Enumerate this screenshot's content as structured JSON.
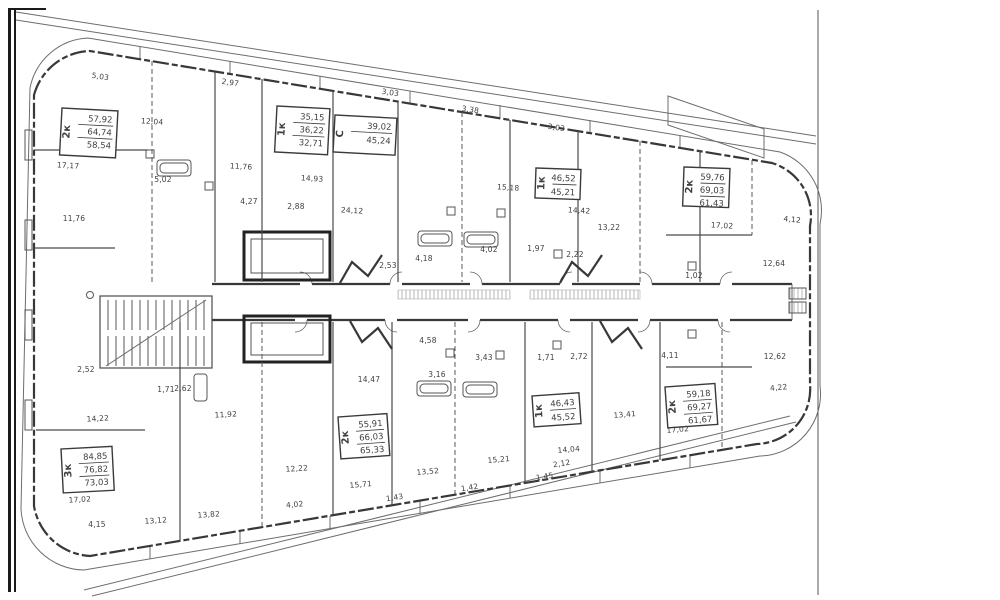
{
  "drawing": {
    "kind": "residential-floor-plan",
    "colors": {
      "paper": "#ffffff",
      "ink": "#3f3f3f",
      "frame": "#1a1a1a",
      "hatch": "#999999"
    }
  },
  "stamps": [
    {
      "type": "2к",
      "areas": [
        "57,92",
        "64,74",
        "58,54"
      ],
      "x": 62,
      "y": 108,
      "w": 56,
      "h": 47,
      "r": 3
    },
    {
      "type": "1к",
      "areas": [
        "35,15",
        "36,22",
        "32,71"
      ],
      "x": 277,
      "y": 106,
      "w": 53,
      "h": 46,
      "r": 3
    },
    {
      "type": "С",
      "areas": [
        "39,02",
        "45,24"
      ],
      "x": 335,
      "y": 115,
      "w": 62,
      "h": 37,
      "r": 3
    },
    {
      "type": "1к",
      "areas": [
        "46,52",
        "45,21"
      ],
      "x": 536,
      "y": 168,
      "w": 45,
      "h": 30,
      "r": 2
    },
    {
      "type": "2к",
      "areas": [
        "59,76",
        "69,03",
        "61,43"
      ],
      "x": 684,
      "y": 167,
      "w": 46,
      "h": 39,
      "r": 2
    },
    {
      "type": "3к",
      "areas": [
        "84,85",
        "76,82",
        "73,03"
      ],
      "x": 61,
      "y": 449,
      "w": 51,
      "h": 44,
      "r": -3
    },
    {
      "type": "2к",
      "areas": [
        "55,91",
        "66,03",
        "65,33"
      ],
      "x": 338,
      "y": 417,
      "w": 49,
      "h": 42,
      "r": -4
    },
    {
      "type": "1к",
      "areas": [
        "46,43",
        "45,52"
      ],
      "x": 532,
      "y": 396,
      "w": 47,
      "h": 31,
      "r": -4
    },
    {
      "type": "2к",
      "areas": [
        "59,18",
        "69,27",
        "61,67"
      ],
      "x": 665,
      "y": 387,
      "w": 50,
      "h": 41,
      "r": -4
    }
  ],
  "room_labels": [
    {
      "t": "5,03",
      "x": 100,
      "y": 79,
      "r": 8
    },
    {
      "t": "2,97",
      "x": 230,
      "y": 85,
      "r": 8
    },
    {
      "t": "3,03",
      "x": 390,
      "y": 95,
      "r": 8
    },
    {
      "t": "3,38",
      "x": 470,
      "y": 112,
      "r": 8
    },
    {
      "t": "3,03",
      "x": 556,
      "y": 130,
      "r": 8
    },
    {
      "t": "12,04",
      "x": 152,
      "y": 124,
      "r": 4
    },
    {
      "t": "17,17",
      "x": 68,
      "y": 168,
      "r": 3
    },
    {
      "t": "5,02",
      "x": 163,
      "y": 182,
      "r": 0
    },
    {
      "t": "11,76",
      "x": 241,
      "y": 169,
      "r": 3
    },
    {
      "t": "14,93",
      "x": 312,
      "y": 181,
      "r": 3
    },
    {
      "t": "15,18",
      "x": 508,
      "y": 190,
      "r": 4
    },
    {
      "t": "4,27",
      "x": 249,
      "y": 204,
      "r": 0
    },
    {
      "t": "2,88",
      "x": 296,
      "y": 209,
      "r": 0
    },
    {
      "t": "11,76",
      "x": 74,
      "y": 221,
      "r": 0
    },
    {
      "t": "24,12",
      "x": 352,
      "y": 213,
      "r": 3
    },
    {
      "t": "14,42",
      "x": 579,
      "y": 213,
      "r": 3
    },
    {
      "t": "13,22",
      "x": 609,
      "y": 230,
      "r": 0
    },
    {
      "t": "17,02",
      "x": 722,
      "y": 228,
      "r": 3
    },
    {
      "t": "4,12",
      "x": 792,
      "y": 222,
      "r": 6
    },
    {
      "t": "4,18",
      "x": 424,
      "y": 261,
      "r": 0
    },
    {
      "t": "4,02",
      "x": 489,
      "y": 252,
      "r": 0
    },
    {
      "t": "1,97",
      "x": 536,
      "y": 251,
      "r": 0
    },
    {
      "t": "2,22",
      "x": 575,
      "y": 257,
      "r": 0
    },
    {
      "t": "2,53",
      "x": 388,
      "y": 268,
      "r": 0
    },
    {
      "t": "12,64",
      "x": 774,
      "y": 266,
      "r": 0
    },
    {
      "t": "1,02",
      "x": 694,
      "y": 278,
      "r": 0
    },
    {
      "t": "2,52",
      "x": 86,
      "y": 372,
      "r": 0
    },
    {
      "t": "1,71",
      "x": 166,
      "y": 392,
      "r": 0
    },
    {
      "t": "2,62",
      "x": 183,
      "y": 391,
      "r": 0
    },
    {
      "t": "12,62",
      "x": 775,
      "y": 359,
      "r": 0
    },
    {
      "t": "4,11",
      "x": 670,
      "y": 358,
      "r": 0
    },
    {
      "t": "4,22",
      "x": 779,
      "y": 390,
      "r": -6
    },
    {
      "t": "14,47",
      "x": 369,
      "y": 382,
      "r": 0
    },
    {
      "t": "4,58",
      "x": 428,
      "y": 343,
      "r": 0
    },
    {
      "t": "3,16",
      "x": 437,
      "y": 377,
      "r": 0
    },
    {
      "t": "3,43",
      "x": 484,
      "y": 360,
      "r": 0
    },
    {
      "t": "1,71",
      "x": 546,
      "y": 360,
      "r": 0
    },
    {
      "t": "2,72",
      "x": 579,
      "y": 359,
      "r": 0
    },
    {
      "t": "14,22",
      "x": 98,
      "y": 421,
      "r": -3
    },
    {
      "t": "11,92",
      "x": 226,
      "y": 417,
      "r": -3
    },
    {
      "t": "17,02",
      "x": 80,
      "y": 502,
      "r": -3
    },
    {
      "t": "4,15",
      "x": 97,
      "y": 527,
      "r": 0
    },
    {
      "t": "13,12",
      "x": 156,
      "y": 523,
      "r": -4
    },
    {
      "t": "13,82",
      "x": 209,
      "y": 517,
      "r": -4
    },
    {
      "t": "12,22",
      "x": 297,
      "y": 471,
      "r": -4
    },
    {
      "t": "4,02",
      "x": 295,
      "y": 507,
      "r": -5
    },
    {
      "t": "15,71",
      "x": 361,
      "y": 487,
      "r": -5
    },
    {
      "t": "13,52",
      "x": 428,
      "y": 474,
      "r": -5
    },
    {
      "t": "15,21",
      "x": 499,
      "y": 462,
      "r": -5
    },
    {
      "t": "14,04",
      "x": 569,
      "y": 452,
      "r": -5
    },
    {
      "t": "13,41",
      "x": 625,
      "y": 417,
      "r": -5
    },
    {
      "t": "17,02",
      "x": 678,
      "y": 432,
      "r": -5
    },
    {
      "t": "1,43",
      "x": 395,
      "y": 500,
      "r": -9
    },
    {
      "t": "1,42",
      "x": 470,
      "y": 490,
      "r": -9
    },
    {
      "t": "1,45",
      "x": 545,
      "y": 479,
      "r": -9
    },
    {
      "t": "2,12",
      "x": 562,
      "y": 466,
      "r": -9
    }
  ]
}
